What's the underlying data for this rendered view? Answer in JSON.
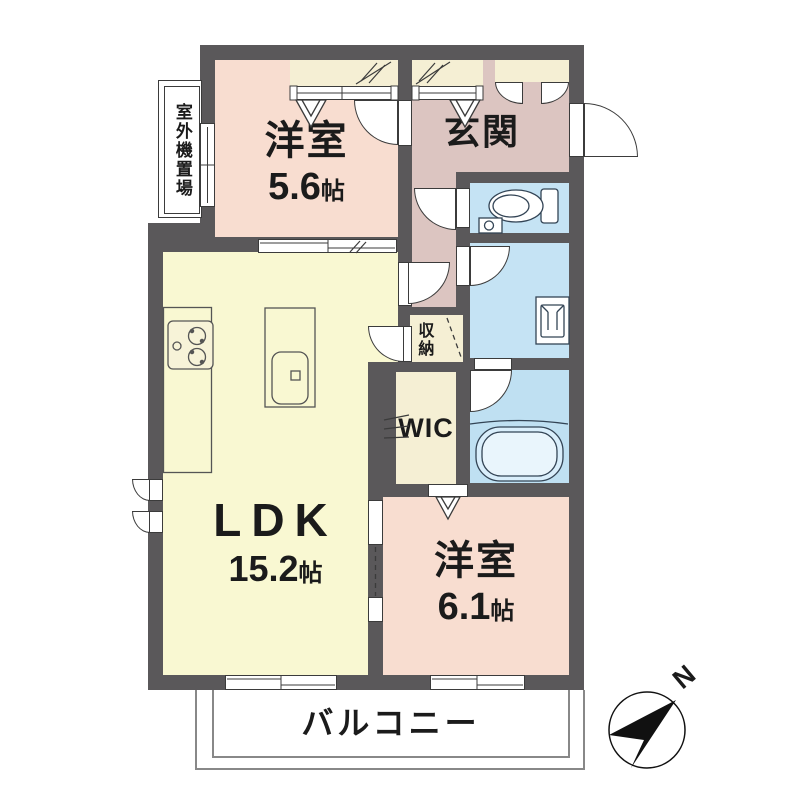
{
  "floorplan": {
    "rooms": {
      "bedroom1": {
        "name": "洋室",
        "size_number": "5.6",
        "size_unit": "帖"
      },
      "entrance": {
        "name": "玄関"
      },
      "ldk": {
        "name": "LDK",
        "size_number": "15.2",
        "size_unit": "帖"
      },
      "bedroom2": {
        "name": "洋室",
        "size_number": "6.1",
        "size_unit": "帖"
      },
      "wic": {
        "name": "WIC"
      },
      "storage": {
        "name": "収納"
      },
      "balcony": {
        "name": "バルコニー"
      },
      "outdoor_unit_area": {
        "name": "室外機置場"
      }
    },
    "compass": {
      "north_label": "N"
    },
    "colors": {
      "wall": "#5a585a",
      "bedroom": "#f8ddd0",
      "entrance_hall": "#dcc5c1",
      "ldk": "#f9f8d2",
      "closet": "#f5efd4",
      "sanitary": "#c5e3f4",
      "bath": "#bfe0f2",
      "bathtub": "#d9eefb",
      "fixture_stroke": "#334455"
    }
  }
}
